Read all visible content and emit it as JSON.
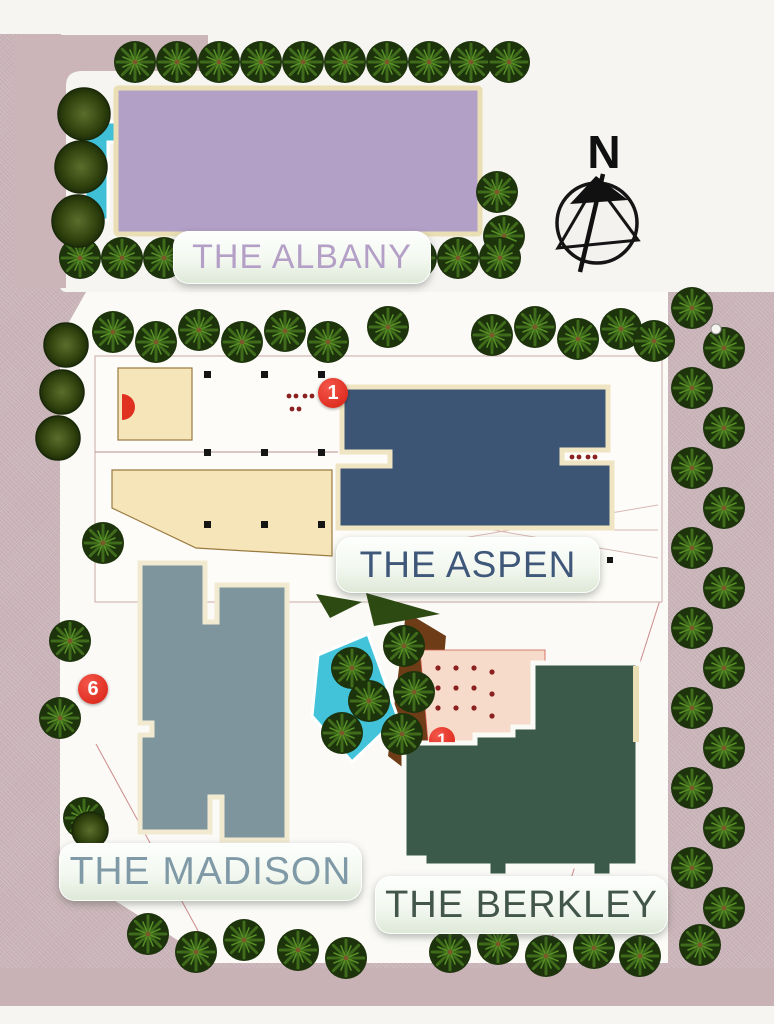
{
  "buildings": [
    {
      "id": "albany",
      "label": "THE ALBANY"
    },
    {
      "id": "aspen",
      "label": "THE ASPEN"
    },
    {
      "id": "madison",
      "label": "THE MADISON"
    },
    {
      "id": "berkley",
      "label": "THE BERKLEY"
    }
  ],
  "markers": [
    {
      "number": "1",
      "near": "aspen"
    },
    {
      "number": "6",
      "near": "madison"
    },
    {
      "number": "1",
      "near": "berkley"
    }
  ],
  "compass": {
    "label": "N"
  },
  "palette": {
    "background_paving": "#cdb9bd",
    "walkway_white": "#fbfaf7",
    "albany_fill": "#b3a0c7",
    "albany_border": "#eadfb4",
    "albany_text": "#b49fc6",
    "aspen_fill": "#3d5574",
    "aspen_border": "#efe5c2",
    "aspen_text": "#3f587a",
    "madison_fill": "#7e959e",
    "madison_border": "#f2ead0",
    "madison_text": "#7f9aa6",
    "berkley_fill": "#3b5a49",
    "berkley_border": "#fafbf7",
    "berkley_text": "#42564a",
    "pool_water": "#3fc0d6",
    "pond_water": "#43c3d9",
    "wood_deck": "#6e3d18",
    "terrace": "#f7dbca",
    "palm_dark": "#1c330c",
    "palm_light": "#3f6b1a",
    "marker_red": "#d71f12",
    "label_plate_bg": "#edf2e8"
  },
  "icons": {
    "north_arrow": "north-arrow-icon",
    "palm": "palm-tree-icon",
    "bush": "bush-icon",
    "marker": "map-marker-badge"
  }
}
